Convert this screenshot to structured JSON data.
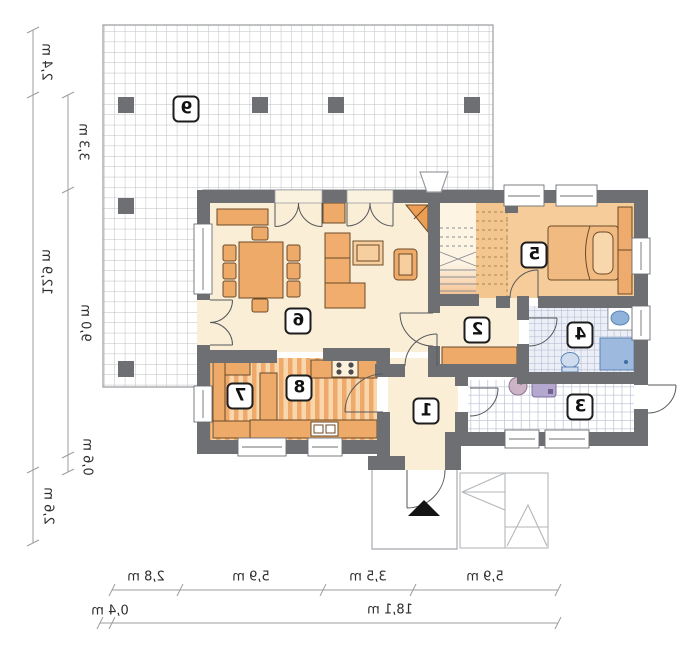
{
  "floor_plan": {
    "rooms": {
      "r1": "1",
      "r2": "2",
      "r3": "3",
      "r4": "4",
      "r5": "5",
      "r6": "6",
      "r7": "7",
      "r8": "8",
      "r9": "9"
    },
    "dimensions": {
      "unit": "m",
      "left_outer": [
        "2,4 m",
        "12,9 m",
        "2,6 m"
      ],
      "left_inner": [
        "3,3 m",
        "9,0 m",
        "0,6 m"
      ],
      "bottom_segments": [
        "2,8 m",
        "5,9 m",
        "3,5 m",
        "5,9 m"
      ],
      "bottom_offset": "0,4 m",
      "bottom_total": "18,1 m"
    },
    "colors": {
      "wall": "#6d6f73",
      "floor_cream": "#fbeed6",
      "floor_bedroom": "#f6cd9a",
      "furniture_orange": "#eeaa68",
      "fixture_blue": "#8fb3da",
      "terrace_grid_line": "#bdbfc3"
    }
  }
}
